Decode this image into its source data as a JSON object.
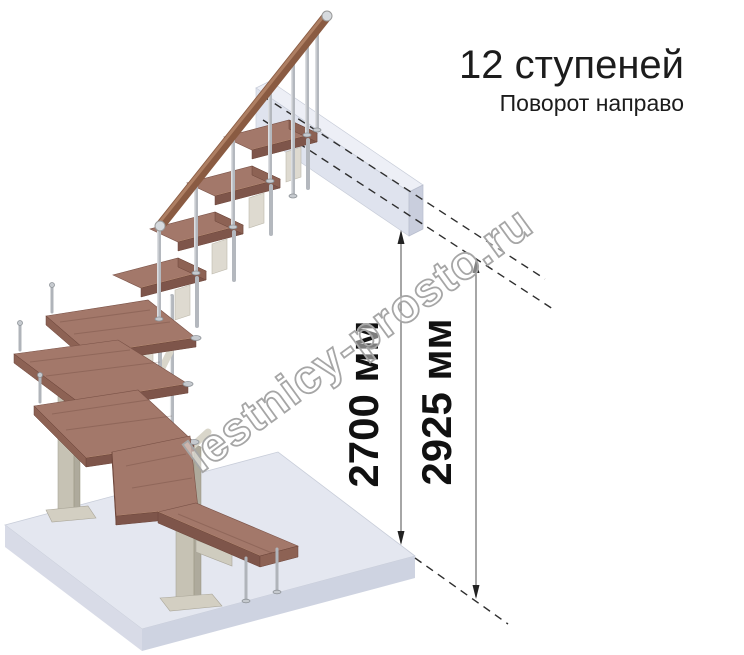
{
  "header": {
    "title": "12 ступеней",
    "subtitle": "Поворот направо"
  },
  "dimensions": {
    "ceiling": {
      "label": "2700 мм"
    },
    "floor_to_floor": {
      "label": "2925 мм"
    }
  },
  "watermark": {
    "text": "lestnicy-prosto.ru"
  },
  "figure": {
    "type": "staircase-3d-illustration",
    "steps_count": 12,
    "turn_direction": "направо",
    "colors": {
      "tread": "#a3786a",
      "tread_front": "#7e554a",
      "handrail": "#8a5b42",
      "metal": "#b4b8be",
      "support": "#c6c2b4",
      "floor_slab": "#e4e7f0",
      "landing_slab": "#dfe3ee",
      "dimension_text": "#111111"
    }
  }
}
